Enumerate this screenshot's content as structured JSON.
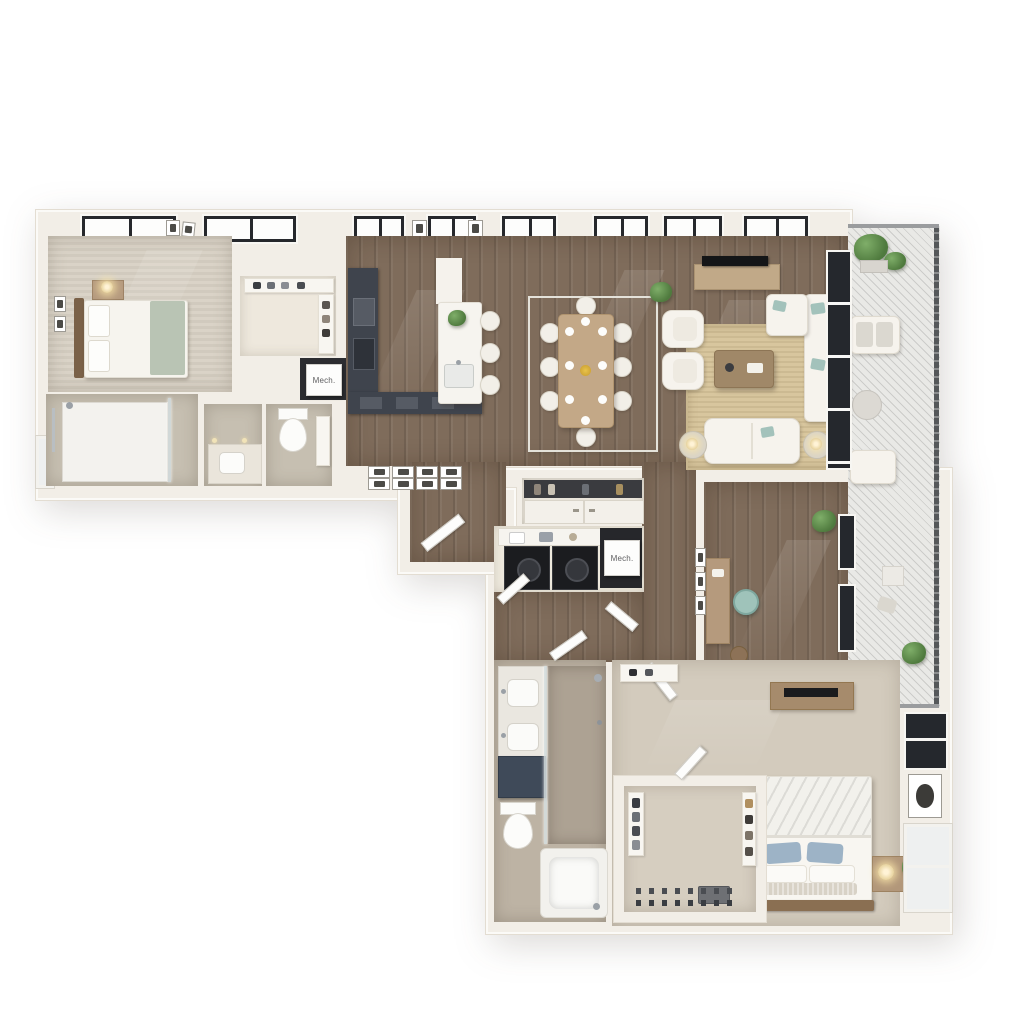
{
  "scene": {
    "type": "3d-floor-plan-render",
    "background": "#ffffff"
  },
  "labels": {
    "mech_closet_upper": "Mech.",
    "mech_closet_middle": "Mech."
  },
  "palette": {
    "exterior_wall": "#f2eee7",
    "wood_floor": "#7f6c5b",
    "carpet": "#d8d1c4",
    "bath_tile": "#c6bfb1",
    "kitchen_cabinet_dark": "#3f444d",
    "appliance_black": "#1b1c1f",
    "window_frame_black": "#26282c",
    "accent_teal": "#a3c2bb",
    "pillow_blue": "#9db3c6",
    "rug_jute": "#d8c69e",
    "plant_green": "#5d8a4c",
    "vanity_navy": "#3f4a59",
    "wood_furniture": "#b59a7e",
    "centerpiece_yellow": "#ddb23f"
  }
}
